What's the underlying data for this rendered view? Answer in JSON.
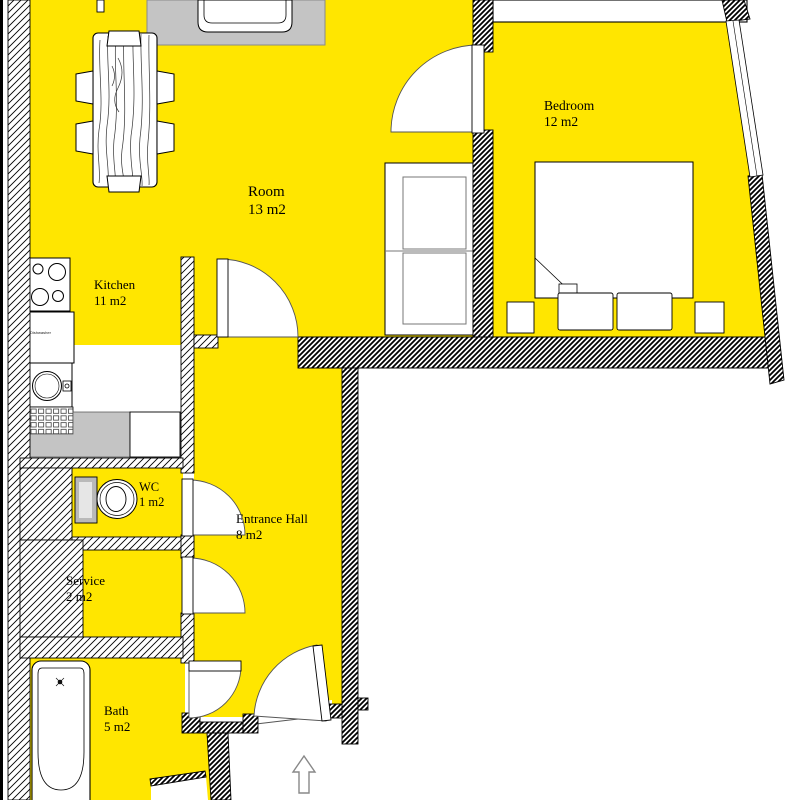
{
  "title": "Apartment floor plan",
  "colors": {
    "floor_highlight": "#FFE600",
    "wall_line": "#000000",
    "rug_gray": "#C4C4C4",
    "background": "#FFFFFF"
  },
  "rooms": [
    {
      "name": "Room",
      "area": "13 m2"
    },
    {
      "name": "Bedroom",
      "area": "12 m2"
    },
    {
      "name": "Kitchen",
      "area": "11 m2"
    },
    {
      "name": "WC",
      "area": "1 m2"
    },
    {
      "name": "Entrance Hall",
      "area": "8 m2"
    },
    {
      "name": "Service",
      "area": "2 m2"
    },
    {
      "name": "Bath",
      "area": "5 m2"
    }
  ],
  "kitchen": {
    "dishwasher_label": "Dishwasher"
  },
  "icons": [
    "dining-table-icon",
    "chair-icon",
    "armchair-icon",
    "rug",
    "wardrobe-icon",
    "closet-icon",
    "double-bed-icon",
    "pillow-icon",
    "nightstand-icon",
    "stove-icon",
    "dishwasher-icon",
    "sink-icon",
    "drainboard-icon",
    "counter",
    "toilet-icon",
    "bathtub-icon",
    "door-arc-icon",
    "window-icon",
    "entrance-arrow-icon"
  ]
}
